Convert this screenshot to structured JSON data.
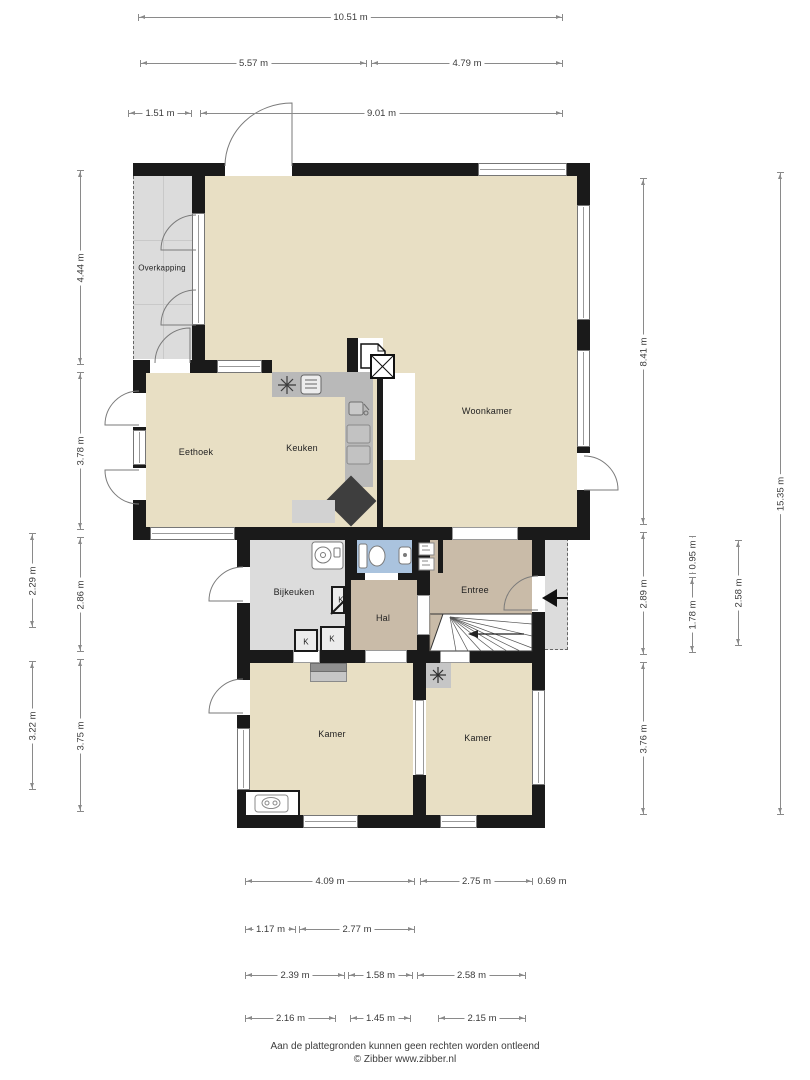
{
  "document": {
    "type": "floor-plan",
    "footer": {
      "line1": "Aan de plattegronden kunnen geen rechten worden ontleend",
      "line2": "© Zibber www.zibber.nl"
    }
  },
  "colors": {
    "floor_living": "#e8dfc4",
    "floor_utility": "#dcdcdc",
    "floor_hall": "#c9bba8",
    "floor_toilet": "#aac3de",
    "wall": "#1a1a1a",
    "counter": "#b9b9b9",
    "counter_dark": "#3e3e3e",
    "dimension_line": "#8a8a8a"
  },
  "rooms": [
    {
      "id": "overkapping",
      "label": "Overkapping",
      "x": 162,
      "y": 268,
      "small": true
    },
    {
      "id": "woonkamer",
      "label": "Woonkamer",
      "x": 487,
      "y": 411,
      "small": false
    },
    {
      "id": "eethoek",
      "label": "Eethoek",
      "x": 196,
      "y": 452,
      "small": false
    },
    {
      "id": "keuken",
      "label": "Keuken",
      "x": 302,
      "y": 448,
      "small": false
    },
    {
      "id": "bijkeuken",
      "label": "Bijkeuken",
      "x": 294,
      "y": 592,
      "small": false
    },
    {
      "id": "hal",
      "label": "Hal",
      "x": 383,
      "y": 618,
      "small": false
    },
    {
      "id": "entree",
      "label": "Entree",
      "x": 475,
      "y": 590,
      "small": false
    },
    {
      "id": "kamer-links",
      "label": "Kamer",
      "x": 332,
      "y": 734,
      "small": false
    },
    {
      "id": "kamer-rechts",
      "label": "Kamer",
      "x": 478,
      "y": 738,
      "small": false
    },
    {
      "id": "kast-1",
      "label": "K",
      "x": 341,
      "y": 600,
      "small": true
    },
    {
      "id": "kast-2",
      "label": "K",
      "x": 306,
      "y": 642,
      "small": true
    },
    {
      "id": "kast-3",
      "label": "K",
      "x": 332,
      "y": 639,
      "small": true
    }
  ],
  "dimensions_horizontal": [
    {
      "label": "10.51 m",
      "x1": 138,
      "x2": 563,
      "y": 17
    },
    {
      "label": "5.57 m",
      "x1": 140,
      "x2": 367,
      "y": 63
    },
    {
      "label": "4.79 m",
      "x1": 371,
      "x2": 563,
      "y": 63
    },
    {
      "label": "1.51 m",
      "x1": 128,
      "x2": 192,
      "y": 113
    },
    {
      "label": "9.01 m",
      "x1": 200,
      "x2": 563,
      "y": 113
    },
    {
      "label": "4.09 m",
      "x1": 245,
      "x2": 415,
      "y": 881
    },
    {
      "label": "2.75 m",
      "x1": 420,
      "x2": 533,
      "y": 881
    },
    {
      "label": "0.69 m",
      "x1": 536,
      "x2": 568,
      "y": 881
    },
    {
      "label": "1.17 m",
      "x1": 245,
      "x2": 296,
      "y": 929
    },
    {
      "label": "2.77 m",
      "x1": 299,
      "x2": 415,
      "y": 929
    },
    {
      "label": "2.39 m",
      "x1": 245,
      "x2": 345,
      "y": 975
    },
    {
      "label": "1.58 m",
      "x1": 348,
      "x2": 413,
      "y": 975
    },
    {
      "label": "2.58 m",
      "x1": 417,
      "x2": 526,
      "y": 975
    },
    {
      "label": "2.16 m",
      "x1": 245,
      "x2": 336,
      "y": 1018
    },
    {
      "label": "1.45 m",
      "x1": 350,
      "x2": 411,
      "y": 1018
    },
    {
      "label": "2.15 m",
      "x1": 438,
      "x2": 526,
      "y": 1018
    }
  ],
  "dimensions_vertical": [
    {
      "label": "2.29 m",
      "x": 32,
      "y1": 533,
      "y2": 628
    },
    {
      "label": "3.22 m",
      "x": 32,
      "y1": 661,
      "y2": 790
    },
    {
      "label": "4.44 m",
      "x": 80,
      "y1": 170,
      "y2": 365
    },
    {
      "label": "3.78 m",
      "x": 80,
      "y1": 372,
      "y2": 530
    },
    {
      "label": "2.86 m",
      "x": 80,
      "y1": 537,
      "y2": 652
    },
    {
      "label": "3.75 m",
      "x": 80,
      "y1": 659,
      "y2": 812
    },
    {
      "label": "8.41 m",
      "x": 643,
      "y1": 178,
      "y2": 525
    },
    {
      "label": "2.89 m",
      "x": 643,
      "y1": 532,
      "y2": 655
    },
    {
      "label": "3.76 m",
      "x": 643,
      "y1": 662,
      "y2": 815
    },
    {
      "label": "0.95 m",
      "x": 692,
      "y1": 536,
      "y2": 574
    },
    {
      "label": "1.78 m",
      "x": 692,
      "y1": 577,
      "y2": 653
    },
    {
      "label": "2.58 m",
      "x": 738,
      "y1": 540,
      "y2": 646
    },
    {
      "label": "15.35 m",
      "x": 780,
      "y1": 172,
      "y2": 815
    }
  ]
}
